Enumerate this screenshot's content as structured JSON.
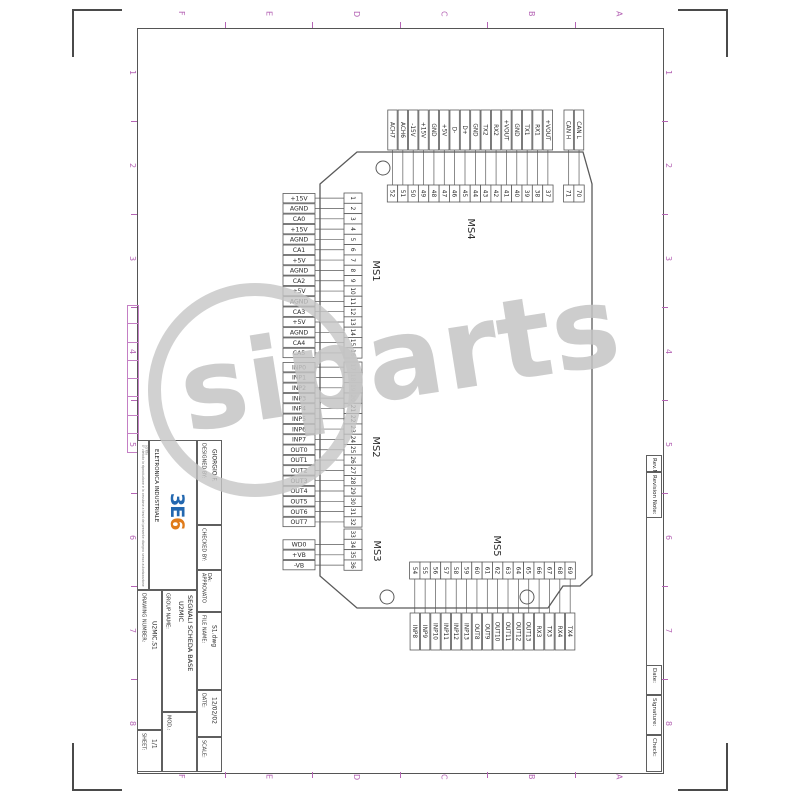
{
  "frame": {
    "accent_color": "#b565b5",
    "zone_letters": [
      "F",
      "E",
      "D",
      "C",
      "B",
      "A"
    ],
    "zone_numbers": [
      "1",
      "2",
      "3",
      "4",
      "5",
      "6",
      "7",
      "8"
    ]
  },
  "revision_strip": {
    "cells": [
      {
        "label": "Rev.No"
      },
      {
        "label": "Revision Note:"
      },
      {
        "label": "Date:"
      },
      {
        "label": "Signature:"
      },
      {
        "label": "Check:"
      }
    ]
  },
  "title_block": {
    "designed_by_label": "DESIGNED BY:",
    "designed_by": "GIORGIO F.",
    "checked_by_label": "CHECKED BY:",
    "approved_label": "APPROVATO DA:",
    "file_name_label": "FILE NAME:",
    "file_name": "S1.dwg",
    "date_label": "DATE:",
    "date": "12/02/02",
    "scale_label": "SCALE:",
    "group_name_label": "GROUP NAME:",
    "group_name_line1": "U2MIC",
    "group_name_line2": "SEGNALI SCHEDA BASE",
    "drawing_number_label": "DRAWING NUMBER:",
    "drawing_number": "U2MIC.S1",
    "mod_label": "MOD.:",
    "sheet_label": "SHEET:",
    "sheet": "1/1",
    "company": "ELETRONICA INDUSTRIALE",
    "logo_text_blue": "3E",
    "logo_text_orange": "6",
    "logo_blue": "#2368b0",
    "logo_orange": "#e07b1a",
    "fine_print": "E' vietata la riproduzione e la cessione a terzi del presente disegno senza autorizzazione scritta"
  },
  "watermark": {
    "text": "siparts",
    "color": "#c6c6c6"
  },
  "diagram": {
    "line_color": "#5a5a5a",
    "board_outline": [
      [
        320,
        184
      ],
      [
        357,
        152
      ],
      [
        583,
        152
      ],
      [
        592,
        184
      ],
      [
        592,
        575
      ],
      [
        580,
        586
      ],
      [
        563,
        586
      ],
      [
        548,
        608
      ],
      [
        357,
        608
      ],
      [
        320,
        576
      ]
    ],
    "mounting_holes": [
      [
        383,
        168
      ],
      [
        387,
        597
      ],
      [
        527,
        597
      ]
    ],
    "hole_radius": 7,
    "connectors": [
      {
        "name": "MS1",
        "side": "left",
        "origin": 193,
        "name_x": 373,
        "name_y": 271,
        "pins": [
          1,
          2,
          3,
          4,
          5,
          6,
          7,
          8,
          9,
          10,
          11,
          12,
          13,
          14,
          15,
          16
        ],
        "labels": [
          "+15V",
          "AGND",
          "CA0",
          "+15V",
          "AGND",
          "CA1",
          "+5V",
          "AGND",
          "CA2",
          "+5V",
          "AGND",
          "CA3",
          "+5V",
          "AGND",
          "CA4",
          "CA5"
        ]
      },
      {
        "name": "MS2",
        "side": "left",
        "origin": 362,
        "name_x": 373,
        "name_y": 447,
        "pins": [
          17,
          18,
          19,
          20,
          21,
          22,
          23,
          24,
          25,
          26,
          27,
          28,
          29,
          30,
          31,
          32
        ],
        "labels": [
          "INP0",
          "INP1",
          "INP2",
          "INP3",
          "INP4",
          "INP5",
          "INP6",
          "INP7",
          "OUT0",
          "OUT1",
          "OUT2",
          "OUT3",
          "OUT4",
          "OUT5",
          "OUT6",
          "OUT7"
        ]
      },
      {
        "name": "MS3",
        "side": "left",
        "origin": 529,
        "name_x": 374,
        "name_y": 551,
        "pins": [
          33,
          34,
          35,
          36
        ],
        "labels": [
          "WD0",
          "+VB",
          "-VB"
        ],
        "label_pin_offset": 1
      },
      {
        "name": "MS4",
        "side": "top",
        "origin": 387.3,
        "name_x": 468,
        "name_y": 229,
        "pins": [
          52,
          51,
          50,
          49,
          48,
          47,
          46,
          45,
          44,
          43,
          42,
          41,
          40,
          39,
          38,
          37
        ],
        "labels": [
          "ACH7",
          "ACH6",
          "-15V",
          "+15V",
          "GND",
          "+5V",
          "D-",
          "D+",
          "GND",
          "TX2",
          "RX2",
          "+VOUT",
          "GND",
          "TX1",
          "RX1",
          "+VOUT"
        ]
      },
      {
        "name": "",
        "side": "top",
        "origin": 563.5,
        "pins": [
          71,
          70
        ],
        "labels": [
          "CAN H",
          "CAN L"
        ]
      },
      {
        "name": "MS5",
        "side": "bottom",
        "origin": 409.6,
        "name_x": 494,
        "name_y": 546,
        "pins": [
          54,
          55,
          56,
          57,
          58,
          59,
          60,
          61,
          62,
          63,
          64,
          65,
          66,
          67,
          68,
          69
        ],
        "labels": [
          "INP8",
          "INP9",
          "INP10",
          "INP11",
          "INP12",
          "INP13",
          "OUT8",
          "OUT9",
          "OUT10",
          "OUT11",
          "OUT12",
          "OUT13",
          "RX3",
          "TX3",
          "RX4",
          "TX4"
        ]
      }
    ]
  }
}
